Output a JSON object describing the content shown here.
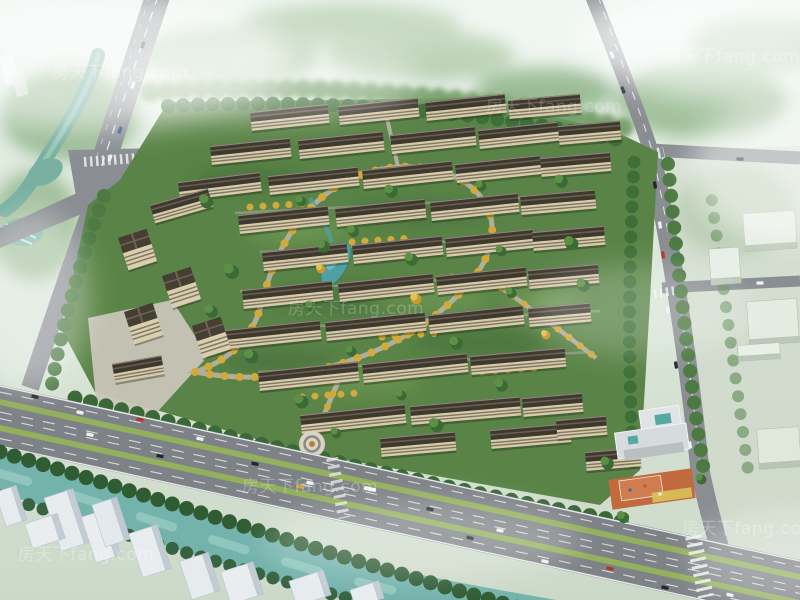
{
  "watermark": {
    "text": "房天下fang.com"
  },
  "colors": {
    "haze": "#e9f2ec",
    "canopy": "#4c7c38",
    "autumn_trees": "#d2a93a",
    "water_river": "#74b2ac",
    "water_pond": "#4fa0a6",
    "roof": "#3e382f",
    "facade": "#d8cbaa",
    "road": "#85898d",
    "highway_median": "#93b05c",
    "sports_court": "#c06a3e",
    "massing_white": "#e6ebee"
  }
}
